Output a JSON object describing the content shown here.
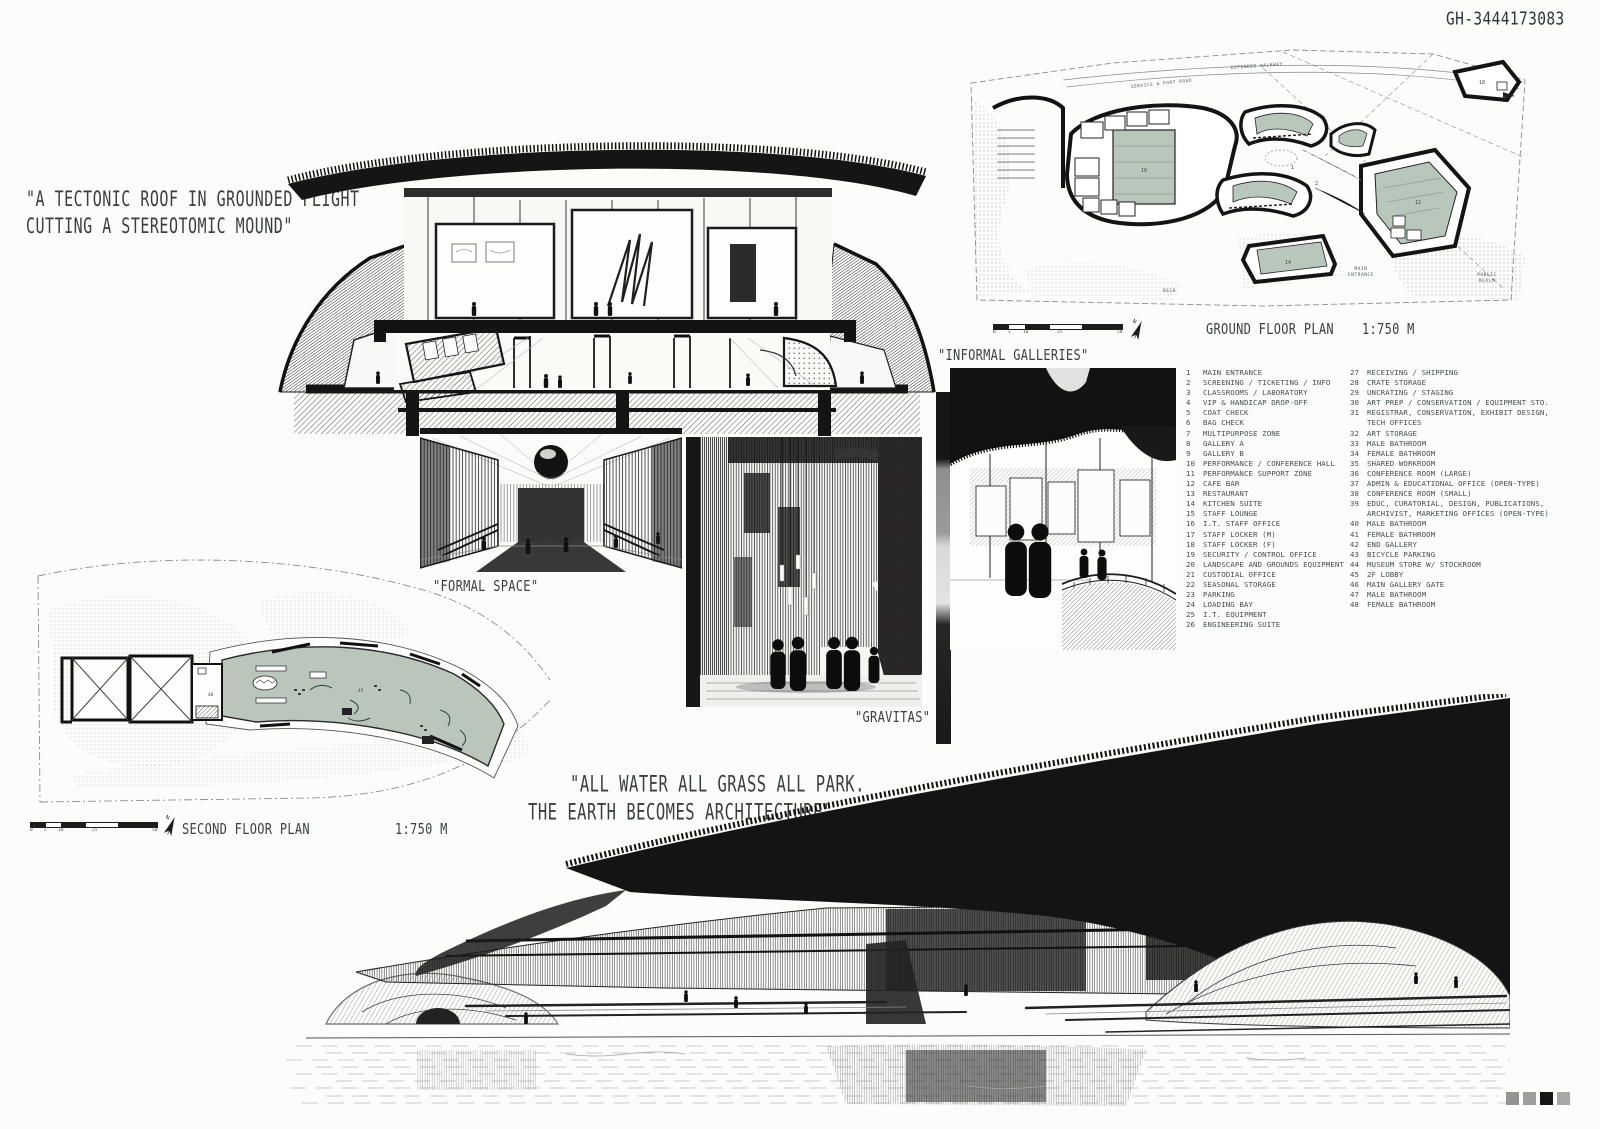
{
  "board": {
    "id_code": "GH-3444173083",
    "paper": "#fcfcfa",
    "ink": "#1a1a1a",
    "plan_fill_green": "#b9c6bc",
    "caption_color": "#3a423e",
    "calibration_squares": [
      "#949494",
      "#9e9e9e",
      "#161616",
      "#a8a8a8"
    ]
  },
  "quotes": {
    "tectonic_line1": "\"A TECTONIC ROOF IN GROUNDED FLIGHT",
    "tectonic_line2": "CUTTING A STEREOTOMIC MOUND\"",
    "earth_line1": "\"ALL WATER ALL GRASS ALL PARK.",
    "earth_line2": "THE EARTH BECOMES ARCHITECTURE\""
  },
  "captions": {
    "formal_space": "\"FORMAL SPACE\"",
    "informal_galleries": "\"INFORMAL GALLERIES\"",
    "gravitas": "\"GRAVITAS\""
  },
  "plans": {
    "scale_ticks": [
      "0",
      "5",
      "10",
      "25",
      "50"
    ],
    "ground": {
      "title": "GROUND FLOOR PLAN",
      "scale": "1:750 M",
      "north": "N",
      "labels": {
        "walkway": "EXTENDED WALKWAY",
        "road": "SERVICE & PORT ROAD",
        "main_entrance_1": "MAIN",
        "main_entrance_2": "ENTRANCE",
        "public_realm_1": "PUBLIC",
        "public_realm_2": "REALM",
        "deck": "DECK"
      },
      "numbers": {
        "hall": "10",
        "plaza": "1",
        "court": "2",
        "east_hall": "12",
        "pavilion": "14",
        "annex": "18"
      }
    },
    "second": {
      "title": "SECOND FLOOR PLAN",
      "scale": "1:750 M",
      "north": "N",
      "numbers": {
        "lobby": "45",
        "gate": "46"
      }
    }
  },
  "legend": {
    "column1": [
      {
        "num": "1",
        "label": "MAIN ENTRANCE"
      },
      {
        "num": "2",
        "label": "SCREENING / TICKETING / INFO"
      },
      {
        "num": "3",
        "label": "CLASSROOMS / LABORATORY"
      },
      {
        "num": "4",
        "label": "VIP & HANDICAP DROP-OFF"
      },
      {
        "num": "5",
        "label": "COAT CHECK"
      },
      {
        "num": "6",
        "label": "BAG CHECK"
      },
      {
        "num": "7",
        "label": "MULTIPURPOSE ZONE"
      },
      {
        "num": "8",
        "label": "GALLERY A"
      },
      {
        "num": "9",
        "label": "GALLERY B"
      },
      {
        "num": "10",
        "label": "PERFORMANCE / CONFERENCE HALL"
      },
      {
        "num": "11",
        "label": "PERFORMANCE SUPPORT ZONE"
      },
      {
        "num": "12",
        "label": "CAFE BAR"
      },
      {
        "num": "13",
        "label": "RESTAURANT"
      },
      {
        "num": "14",
        "label": "KITCHEN SUITE"
      },
      {
        "num": "15",
        "label": "STAFF LOUNGE"
      },
      {
        "num": "16",
        "label": "I.T. STAFF OFFICE"
      },
      {
        "num": "17",
        "label": "STAFF LOCKER (M)"
      },
      {
        "num": "18",
        "label": "STAFF LOCKER (F)"
      },
      {
        "num": "19",
        "label": "SECURITY / CONTROL OFFICE"
      },
      {
        "num": "20",
        "label": "LANDSCAPE AND GROUNDS EQUIPMENT"
      },
      {
        "num": "21",
        "label": "CUSTODIAL OFFICE"
      },
      {
        "num": "22",
        "label": "SEASONAL STORAGE"
      },
      {
        "num": "23",
        "label": "PARKING"
      },
      {
        "num": "24",
        "label": "LOADING BAY"
      },
      {
        "num": "25",
        "label": "I.T. EQUIPMENT"
      },
      {
        "num": "26",
        "label": "ENGINEERING SUITE"
      }
    ],
    "column2": [
      {
        "num": "27",
        "label": "RECEIVING / SHIPPING"
      },
      {
        "num": "28",
        "label": "CRATE STORAGE"
      },
      {
        "num": "29",
        "label": "UNCRATING / STAGING"
      },
      {
        "num": "30",
        "label": "ART PREP / CONSERVATION / EQUIPMENT STO."
      },
      {
        "num": "31",
        "label": "REGISTRAR, CONSERVATION, EXHIBIT DESIGN, TECH OFFICES"
      },
      {
        "num": "32",
        "label": "ART STORAGE"
      },
      {
        "num": "33",
        "label": "MALE BATHROOM"
      },
      {
        "num": "34",
        "label": "FEMALE BATHROOM"
      },
      {
        "num": "35",
        "label": "SHARED WORKROOM"
      },
      {
        "num": "36",
        "label": "CONFERENCE ROOM (LARGE)"
      },
      {
        "num": "37",
        "label": "ADMIN & EDUCATIONAL OFFICE (OPEN-TYPE)"
      },
      {
        "num": "38",
        "label": "CONFERENCE ROOM (SMALL)"
      },
      {
        "num": "39",
        "label": "EDUC, CURATORIAL, DESIGN, PUBLICATIONS, ARCHIVIST, MARKETING OFFICES (OPEN-TYPE)"
      },
      {
        "num": "40",
        "label": "MALE BATHROOM"
      },
      {
        "num": "41",
        "label": "FEMALE BATHROOM"
      },
      {
        "num": "42",
        "label": "END GALLERY"
      },
      {
        "num": "43",
        "label": "BICYCLE PARKING"
      },
      {
        "num": "44",
        "label": "MUSEUM STORE W/ STOCKROOM"
      },
      {
        "num": "45",
        "label": "2F LOBBY"
      },
      {
        "num": "46",
        "label": "MAIN GALLERY GATE"
      },
      {
        "num": "47",
        "label": "MALE BATHROOM"
      },
      {
        "num": "48",
        "label": "FEMALE BATHROOM"
      }
    ]
  }
}
